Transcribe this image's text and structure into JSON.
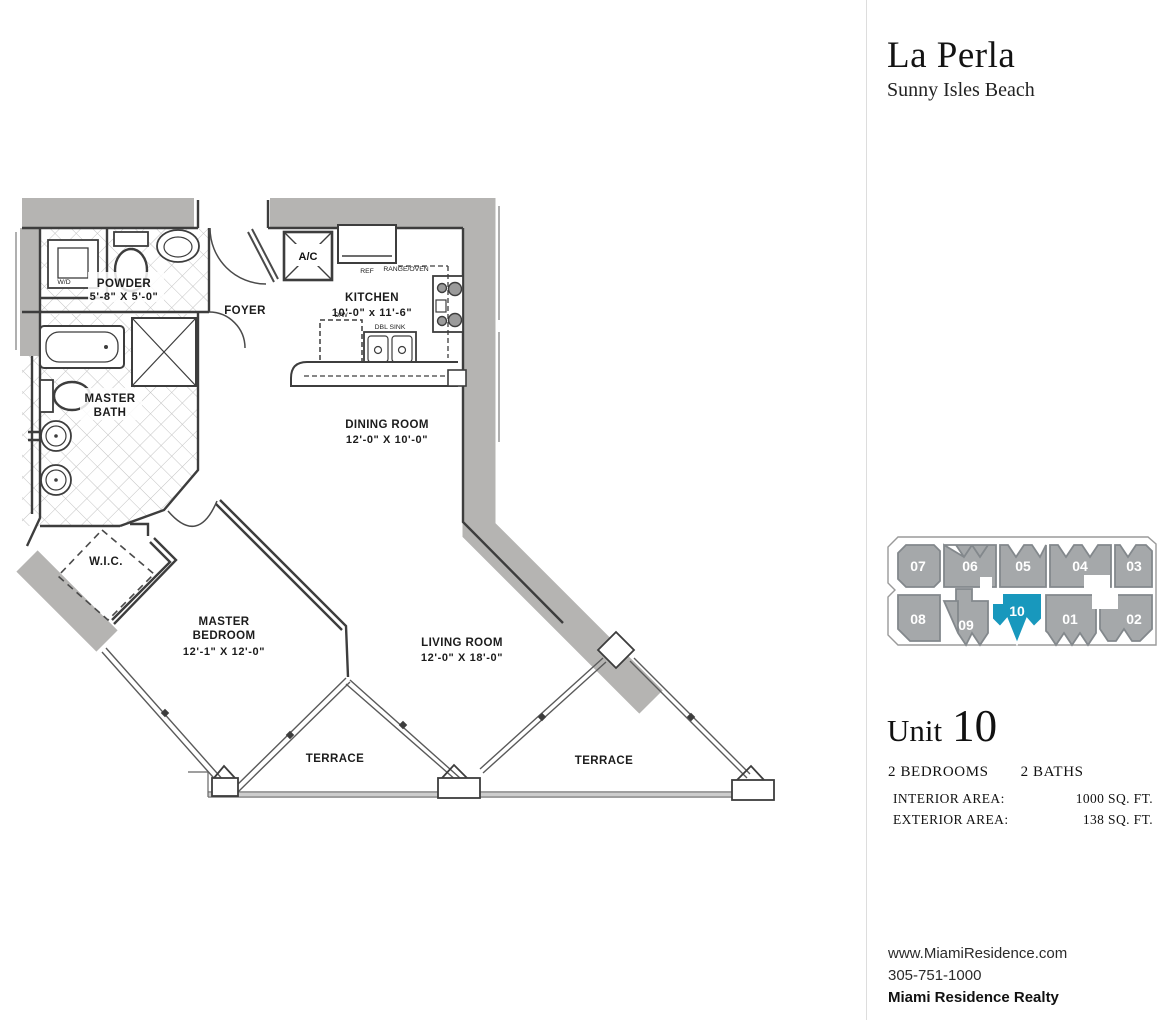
{
  "header": {
    "title": "La Perla",
    "subtitle": "Sunny Isles Beach"
  },
  "floorplan": {
    "wall_color": "#b5b4b2",
    "labels": {
      "powder": "POWDER",
      "powder_dim": "5'-8\" X 5'-0\"",
      "foyer": "FOYER",
      "kitchen": "KITCHEN",
      "kitchen_dim": "10'-0\" x 11'-6\"",
      "master_bath_line1": "MASTER",
      "master_bath_line2": "BATH",
      "dining": "DINING ROOM",
      "dining_dim": "12'-0\" X 10'-0\"",
      "wic": "W.I.C.",
      "bedroom_line1": "MASTER",
      "bedroom_line2": "BEDROOM",
      "bedroom_dim": "12'-1\" X 12'-0\"",
      "living": "LIVING ROOM",
      "living_dim": "12'-0\" X 18'-0\"",
      "terrace_left": "TERRACE",
      "terrace_right": "TERRACE",
      "ac": "A/C",
      "ref": "REF",
      "range_oven": "RANGE/OVEN",
      "dw": "D/W",
      "dbl_sink": "DBL SINK",
      "wd": "W/D"
    }
  },
  "keyplan": {
    "units": [
      "07",
      "06",
      "05",
      "04",
      "03",
      "08",
      "09",
      "10",
      "01",
      "02"
    ],
    "highlighted_unit": "10",
    "unit_color": "#a5a8aa",
    "highlight_color": "#1898bd",
    "label_color": "#ffffff"
  },
  "unit_info": {
    "unit_label": "Unit",
    "unit_number": "10",
    "bedrooms": "2 BEDROOMS",
    "baths": "2 BATHS",
    "areas": [
      {
        "label": "INTERIOR AREA:",
        "sqft": "1000 SQ. FT.",
        "m2": "93 M²"
      },
      {
        "label": "EXTERIOR AREA:",
        "sqft": "138 SQ. FT.",
        "m2": "13 M²"
      }
    ]
  },
  "footer": {
    "website": "www.MiamiResidence.com",
    "phone": "305-751-1000",
    "company": "Miami Residence Realty"
  }
}
